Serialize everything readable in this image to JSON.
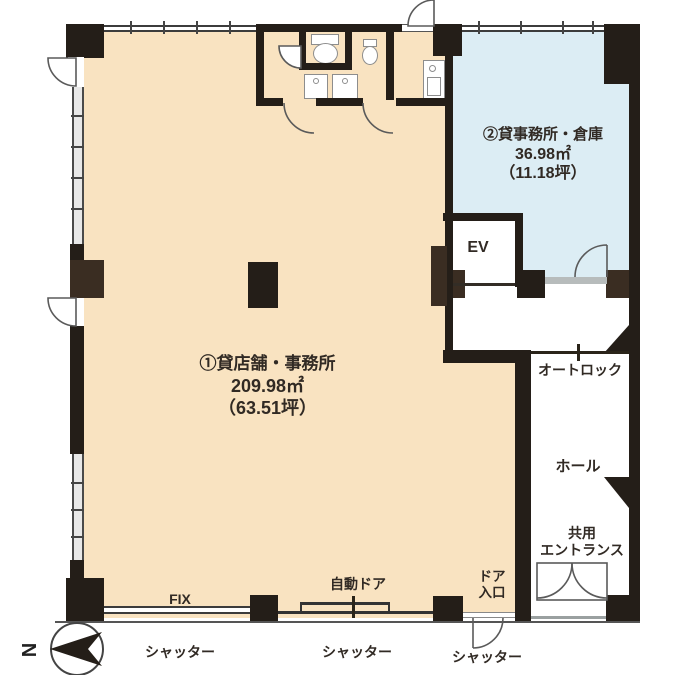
{
  "rooms": {
    "shop": {
      "name": "①貸店舗・事務所",
      "area": "209.98㎡",
      "tsubo": "（63.51坪）"
    },
    "office": {
      "name": "②貸事務所・倉庫",
      "area": "36.98㎡",
      "tsubo": "（11.18坪）"
    },
    "elevator": {
      "label": "EV"
    },
    "autolock": {
      "label": "オートロック"
    },
    "hall": {
      "label": "ホール"
    },
    "entrance": {
      "line1": "共用",
      "line2": "エントランス"
    }
  },
  "openings": {
    "fix": "FIX",
    "auto_door": "自動ドア",
    "door_line1": "ドア",
    "door_line2": "入口",
    "shutter_left": "シャッター",
    "shutter_center": "シャッター",
    "shutter_right": "シャッター"
  },
  "compass": {
    "north": "N"
  },
  "colors": {
    "wall": "#241e18",
    "pillar": "#3a2d22",
    "shop_fill": "#f9e3c1",
    "office_fill": "#dcedf4",
    "window_gray": "#e8e8e8",
    "sill_gray": "#b7bcbc"
  }
}
